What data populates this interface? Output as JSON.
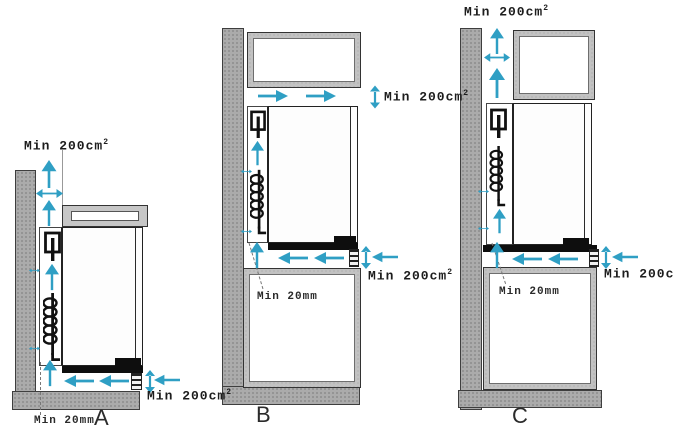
{
  "figure": {
    "colors": {
      "airflow_arrow": "#2f9fc4",
      "wall_fill": "#ababab",
      "cabinet_fill": "#c2c2c2",
      "line": "#161616"
    },
    "diagrams": [
      {
        "letter": "A",
        "top_vent": {
          "text": "Min 200cm",
          "sup": "2"
        },
        "bottom_vent": {
          "text": "Min 200cm",
          "sup": "2"
        },
        "rear_gap": "Min 20mm"
      },
      {
        "letter": "B",
        "top_vent": {
          "text": "Min 200cm",
          "sup": "2"
        },
        "bottom_vent": {
          "text": "Min 200cm",
          "sup": "2"
        },
        "rear_gap": "Min 20mm"
      },
      {
        "letter": "C",
        "top_vent": {
          "text": "Min 200cm",
          "sup": "2"
        },
        "bottom_vent": {
          "text": "Min 200cm",
          "sup": "2"
        },
        "rear_gap": "Min 20mm"
      }
    ]
  }
}
